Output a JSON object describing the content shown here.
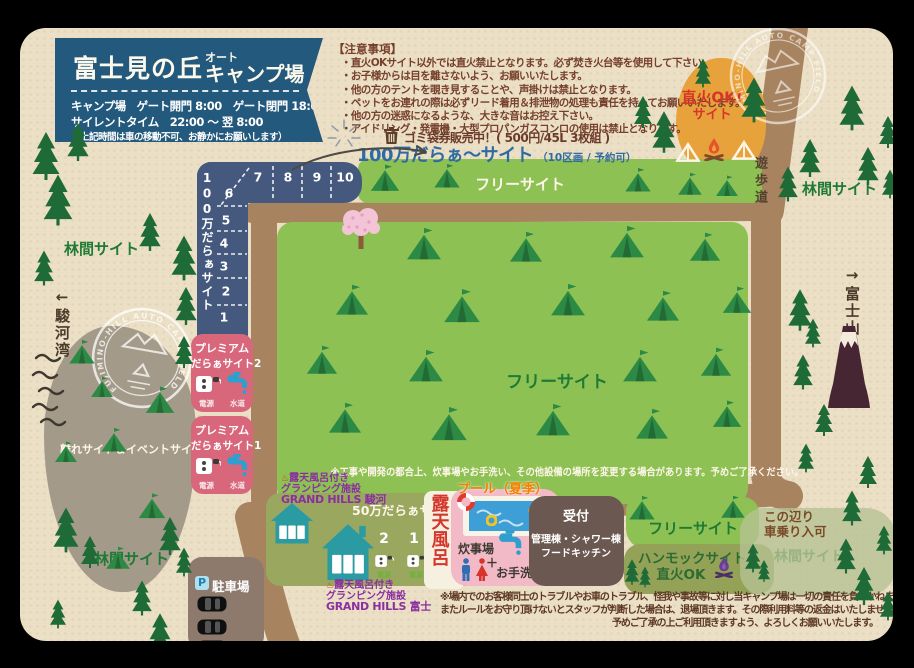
{
  "banner": {
    "title_main": "富士見の丘",
    "title_sub": "オート",
    "title_tail": "キャンプ場",
    "info1": "キャンプ場　ゲート開門 8:00　ゲート閉門 18:00",
    "info2": "サイレントタイム　22:00 ～ 翌 8:00",
    "info3": "（上記時間は車の移動不可、お静かにお願いします）"
  },
  "notes": {
    "heading": "【注意事項】",
    "items": [
      "・直火OKサイト以外では直火禁止となります。必ず焚き火台等を使用して下さい。",
      "・お子様からは目を離さないよう、お願いいたします。",
      "・他の方のテントを覗き見することや、声掛けは禁止となります。",
      "・ペットをお連れの際は必ずリード着用＆排泄物の処理も責任を持ってお願いいたします。",
      "・他の方の迷惑になるような、大きな音はお控え下さい。",
      "・アイドリング・発電機・大型プロパンガスコンロの使用は禁止となります。"
    ],
    "garbage_sale": "ゴミ袋券販売中！( 500円/45L 3枚組 )"
  },
  "stamp_text": "FUJIMINO-HILL AUTO CAMP FIELD",
  "million_site": {
    "header": "100万だらぁ～サイト",
    "header_sub": "（10区画 / 予約可）",
    "vertical_label": "100万だらぁサイト",
    "numbers": [
      "1",
      "2",
      "3",
      "4",
      "5",
      "6",
      "7",
      "8",
      "9",
      "10"
    ]
  },
  "free_site_label": "フリーサイト",
  "field_notice": "※工事や開発の都合上、炊事場やお手洗い、その他設備の場所を変更する場合があります。予めご了承ください。",
  "jikabi_site": {
    "line1": "直火OK!",
    "line2": "サイト"
  },
  "yuhodo": "遊歩道",
  "rinkan_label": "林間サイト",
  "suruga_bay": {
    "arrow": "←",
    "label": "駿河湾"
  },
  "fuji": {
    "arrow": "→",
    "label": "富士山"
  },
  "hanare_label": "離れサイト＆イベントサイト",
  "premium_site2": {
    "line1": "プレミアム",
    "line2": "だらぁサイト2",
    "power": "電源",
    "water": "水道"
  },
  "premium_site1": {
    "line1": "プレミアム",
    "line2": "だらぁサイト1",
    "power": "電源",
    "water": "水道"
  },
  "gojuman_site": {
    "label": "50万だらぁサイト",
    "site2": "2",
    "site1": "1",
    "power": "電源"
  },
  "glamping_suruga": {
    "mark": "♨",
    "line1": "露天風呂付き",
    "line2": "グランピング施設",
    "line3": "GRAND HILLS 駿河"
  },
  "glamping_fuji": {
    "mark": "♨",
    "line1": "露天風呂付き",
    "line2": "グランピング施設",
    "line3": "GRAND HILLS 富士"
  },
  "rotenburo": {
    "label": "露天風呂",
    "sub": "（建設予定地）"
  },
  "pool_label": "プール（夏季）",
  "cooking": {
    "line1": "炊事場",
    "plus": "＋",
    "line2": "お手洗い"
  },
  "reception": {
    "line1": "受付",
    "line2": "管理棟・シャワー棟",
    "line3": "フードキッチン"
  },
  "parking": {
    "p": "P",
    "label": "駐車場"
  },
  "hammock": {
    "line1": "ハンモックサイト",
    "line2": "直火OK"
  },
  "entry_area": {
    "line1": "この辺り",
    "line2": "車乗り入可"
  },
  "bottom_warning": [
    "※場内でのお客様同士のトラブルやお車のトラブル、怪我や事故等に対し当キャンプ場は一切の責任を負いかねます。",
    "またルールをお守り頂けないとスタッフが判断した場合は、退場頂きます。その際利用料等の返金はいたしません。",
    "予めご了承の上ご利用頂きますよう、よろしくお願いいたします。"
  ],
  "colors": {
    "map_bg": "#ebdfc5",
    "road": "#a7835f",
    "field_green": "#8ec153",
    "tent_green": "#2c8a45",
    "tree_green": "#1e6b38",
    "banner_blue": "#23597c",
    "band_blue": "#45597e",
    "header_blue": "#2f6ba3",
    "note_brown": "#76402c",
    "jikabi_orange": "#e8a23b",
    "alert_red": "#d5362c",
    "premium_pink": "#d9677c",
    "hanare_gray": "#a39a89",
    "olive": "#9aa75e",
    "glamp_teal": "#2a9aa3",
    "glamp_purple": "#8a2fa0",
    "reception_brown": "#6b5951",
    "cook_pink": "#f2bac6",
    "pool_blue": "#3e9ed6",
    "sage": "#b7c294",
    "parking_brown": "#8d7a6d",
    "warning_brown": "#5c3825"
  },
  "map_features": {
    "trees": [
      [
        46,
        156,
        30
      ],
      [
        78,
        142,
        24
      ],
      [
        58,
        200,
        32
      ],
      [
        150,
        232,
        24
      ],
      [
        184,
        258,
        28
      ],
      [
        44,
        268,
        22
      ],
      [
        186,
        306,
        24
      ],
      [
        184,
        352,
        20
      ],
      [
        66,
        530,
        28
      ],
      [
        90,
        552,
        20
      ],
      [
        170,
        536,
        24
      ],
      [
        184,
        562,
        18
      ],
      [
        142,
        598,
        22
      ],
      [
        160,
        634,
        26
      ],
      [
        58,
        614,
        18
      ],
      [
        643,
        112,
        20
      ],
      [
        664,
        132,
        26
      ],
      [
        703,
        73,
        18
      ],
      [
        754,
        100,
        28
      ],
      [
        852,
        108,
        28
      ],
      [
        888,
        132,
        20
      ],
      [
        810,
        158,
        24
      ],
      [
        868,
        166,
        24
      ],
      [
        890,
        184,
        18
      ],
      [
        788,
        184,
        22
      ],
      [
        800,
        310,
        26
      ],
      [
        813,
        333,
        18
      ],
      [
        803,
        372,
        22
      ],
      [
        824,
        420,
        20
      ],
      [
        806,
        458,
        18
      ],
      [
        868,
        472,
        20
      ],
      [
        852,
        508,
        22
      ],
      [
        884,
        540,
        18
      ],
      [
        846,
        556,
        22
      ],
      [
        864,
        586,
        24
      ],
      [
        888,
        606,
        18
      ],
      [
        632,
        572,
        16
      ],
      [
        645,
        577,
        13
      ],
      [
        753,
        558,
        18
      ],
      [
        764,
        571,
        14
      ]
    ],
    "strip_tents": [
      [
        385,
        178,
        34
      ],
      [
        447,
        176,
        30
      ],
      [
        638,
        180,
        30
      ],
      [
        690,
        184,
        28
      ],
      [
        727,
        186,
        26
      ]
    ],
    "field_tents": [
      [
        424,
        244,
        40
      ],
      [
        526,
        247,
        38
      ],
      [
        627,
        242,
        40
      ],
      [
        705,
        247,
        36
      ],
      [
        352,
        300,
        38
      ],
      [
        462,
        306,
        42
      ],
      [
        568,
        300,
        40
      ],
      [
        663,
        306,
        38
      ],
      [
        737,
        300,
        34
      ],
      [
        322,
        360,
        36
      ],
      [
        426,
        366,
        40
      ],
      [
        640,
        366,
        40
      ],
      [
        716,
        362,
        36
      ],
      [
        345,
        418,
        38
      ],
      [
        449,
        424,
        42
      ],
      [
        553,
        420,
        40
      ],
      [
        652,
        424,
        38
      ],
      [
        727,
        414,
        34
      ]
    ],
    "hanare_tents": [
      [
        82,
        352,
        30
      ],
      [
        102,
        387,
        26
      ],
      [
        160,
        400,
        34
      ],
      [
        66,
        452,
        26
      ],
      [
        114,
        440,
        30
      ],
      [
        152,
        506,
        32
      ],
      [
        118,
        558,
        28
      ]
    ],
    "free_small_tents": [
      [
        642,
        508,
        30
      ],
      [
        733,
        507,
        28
      ]
    ],
    "jikabi_tents": [
      [
        688,
        152,
        26
      ],
      [
        744,
        150,
        26
      ]
    ],
    "campfires": [
      [
        714,
        149,
        24,
        "orange"
      ],
      [
        724,
        567,
        22,
        "purple"
      ]
    ],
    "waves": [
      [
        38,
        358
      ],
      [
        36,
        375
      ],
      [
        41,
        391
      ],
      [
        36,
        407
      ],
      [
        43,
        421
      ]
    ],
    "cars": [
      [
        212,
        604
      ],
      [
        212,
        627
      ],
      [
        212,
        648
      ]
    ]
  }
}
